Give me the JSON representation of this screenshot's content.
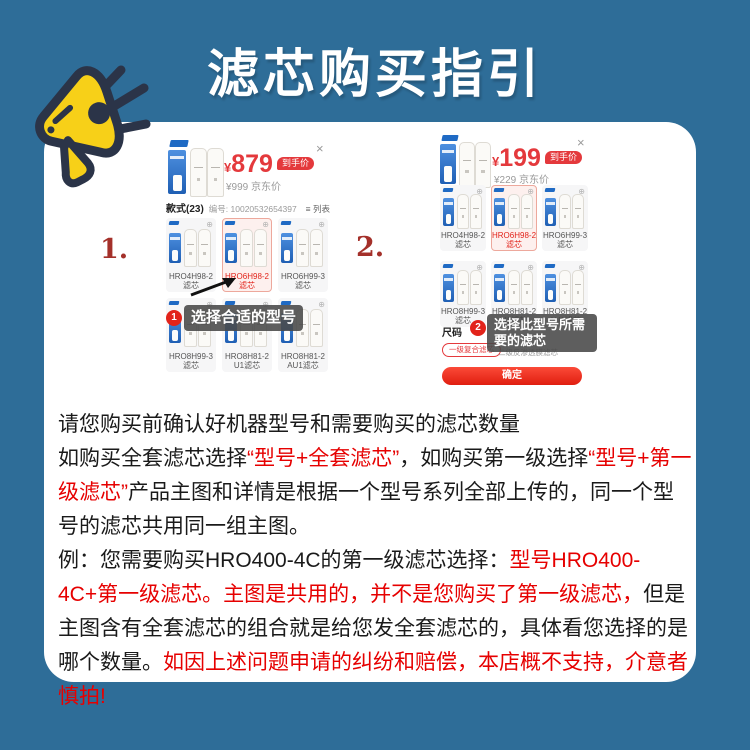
{
  "colors": {
    "page_bg": "#2e6d98",
    "card_bg": "#ffffff",
    "accent_red": "#e4393c",
    "text_red": "#e60000",
    "tooltip_bg": "rgba(72,72,72,0.88)"
  },
  "header": {
    "title": "滤芯购买指引"
  },
  "icons": {
    "close": "×",
    "magnify": "⊕",
    "list": "≡"
  },
  "steps": [
    {
      "label": "1."
    },
    {
      "label": "2."
    }
  ],
  "screenshot1": {
    "currency": "¥",
    "price": "879",
    "price_badge": "到手价",
    "list_price": "¥999 京东价",
    "styles_label": "款式(23)",
    "code_label": "编号: 10020532654397",
    "view_label": "列表",
    "tiles": [
      "HRO4H98-2滤芯",
      "HRO6H98-2滤芯",
      "HRO6H99-3滤芯",
      "HRO8H99-3滤芯",
      "HRO8H81-2U1滤芯",
      "HRO8H81-2AU1滤芯"
    ],
    "step_badge": "1",
    "tooltip": "选择合适的型号"
  },
  "screenshot2": {
    "currency": "¥",
    "price": "199",
    "price_badge": "到手价",
    "list_price": "¥229 京东价",
    "tiles": [
      "HRO4H98-2滤芯",
      "HRO6H98-2滤芯",
      "HRO6H99-3滤芯",
      "HRO8H99-3滤芯",
      "HRO8H81-2U1滤芯",
      "HRO8H81-2AU1滤芯"
    ],
    "size_label": "尺码",
    "step_badge": "2",
    "tooltip": "选择此型号所需要的滤芯",
    "option_selected": "一级复合滤芯",
    "option_other": "二级反渗透膜滤芯",
    "confirm_label": "确定"
  },
  "notes": {
    "paragraphs": [
      [
        {
          "t": "请您购买前确认好机器型号和需要购买的滤芯数量",
          "c": "k"
        }
      ],
      [
        {
          "t": "如购买全套滤芯选择",
          "c": "k"
        },
        {
          "t": "“型号+全套滤芯”",
          "c": "r"
        },
        {
          "t": "，如购买第一级选择",
          "c": "k"
        },
        {
          "t": "“型号+第一级滤芯”",
          "c": "r"
        },
        {
          "t": "产品主图和详情是根据一个型号系列全部上传的，同一个型号的滤芯共用同一组主图。",
          "c": "k"
        }
      ],
      [
        {
          "t": "例：您需要购买HRO400-4C的第一级滤芯选择：",
          "c": "k"
        },
        {
          "t": "型号HRO400-4C+第一级滤芯。主图是共用的，并不是您购买了第一级滤芯，",
          "c": "r"
        },
        {
          "t": "但是主图含有全套滤芯的组合就是给您发全套滤芯的，具体看您选择的是哪个数量。",
          "c": "k"
        },
        {
          "t": "如因上述问题申请的纠纷和赔偿，本店概不支持，介意者慎拍!",
          "c": "r"
        }
      ]
    ]
  }
}
